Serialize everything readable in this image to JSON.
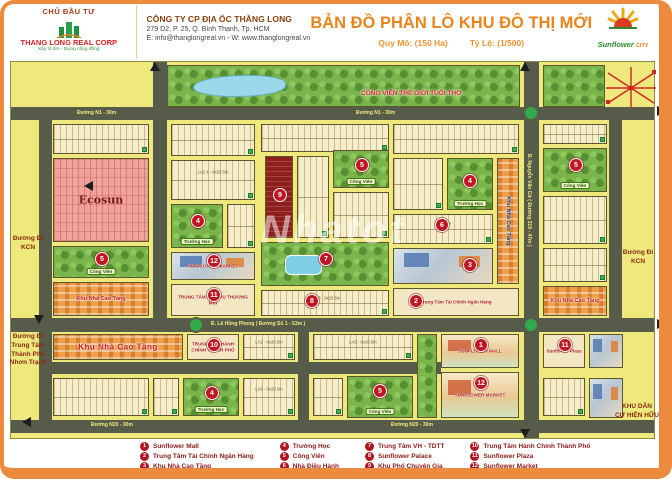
{
  "header": {
    "investor_label": "CHỦ ĐẦU TƯ",
    "logo_name": "THANG LONG REAL CORP",
    "logo_tagline": "Xây tổ ấm - Dựng cộng đồng",
    "company_name": "CÔNG TY CP ĐỊA ỐC THĂNG LONG",
    "company_address": "279 D2, P. 25, Q. Bình Thạnh, Tp. HCM",
    "company_contact": "E: info@thanglongreal.vn - W: www.thanglongreal.vn",
    "title": "BẢN ĐỒ PHÂN LÔ KHU ĐÔ THỊ MỚI",
    "scale_left": "Quy Mô: (150 Ha)",
    "scale_right": "Tỷ Lệ: (1/500)",
    "brand_name": "Sunflower",
    "brand_suffix": "CITY"
  },
  "colors": {
    "frame": "#ec8a3d",
    "title": "#e8851c",
    "road": "#575b4a",
    "map_bg": "#efe87c",
    "marker": "#c01622",
    "legend_text": "#8b1a1a",
    "park": "#79b54a",
    "highrise": "#eda04b",
    "ecosun_pink": "#f0a29b"
  },
  "map": {
    "watermark": "Nhatot",
    "items": [
      {
        "cls": "rh",
        "name": "road-n1",
        "x": 0,
        "y": 45,
        "w": 645,
        "h": 13
      },
      {
        "cls": "rh",
        "name": "road-le-hong-phong",
        "x": 0,
        "y": 256,
        "w": 645,
        "h": 14
      },
      {
        "cls": "rh",
        "name": "road-internal",
        "x": 28,
        "y": 300,
        "w": 402,
        "h": 12
      },
      {
        "cls": "rh",
        "name": "road-n20",
        "x": 0,
        "y": 358,
        "w": 645,
        "h": 13
      },
      {
        "cls": "rv",
        "name": "road-west-edge",
        "x": 28,
        "y": 45,
        "w": 13,
        "h": 326
      },
      {
        "cls": "rv",
        "name": "road-d1",
        "x": 142,
        "y": 0,
        "w": 14,
        "h": 270
      },
      {
        "cls": "rv",
        "name": "road-nguyen-van-cu",
        "x": 513,
        "y": 0,
        "w": 15,
        "h": 378
      },
      {
        "cls": "rv",
        "name": "road-east-edge",
        "x": 598,
        "y": 45,
        "w": 13,
        "h": 225
      },
      {
        "cls": "rv",
        "name": "road-internal-v",
        "x": 287,
        "y": 270,
        "w": 11,
        "h": 88
      },
      {
        "cls": "rb",
        "name": "roundabout",
        "x": 177,
        "y": 255
      },
      {
        "cls": "rb",
        "name": "roundabout",
        "x": 512,
        "y": 43
      },
      {
        "cls": "rb",
        "name": "roundabout",
        "x": 512,
        "y": 255
      },
      {
        "cls": "parkl",
        "name": "park-childhood-world",
        "x": 156,
        "y": 3,
        "w": 353,
        "h": 42
      },
      {
        "cls": "park",
        "name": "park-northeast",
        "x": 532,
        "y": 3,
        "w": 62,
        "h": 42
      },
      {
        "cls": "lots",
        "x": 42,
        "y": 62,
        "w": 96,
        "h": 30
      },
      {
        "cls": "pink",
        "name": "ecosun-area",
        "x": 42,
        "y": 96,
        "w": 96,
        "h": 84,
        "label": "Ecosun"
      },
      {
        "cls": "park",
        "name": "park-block",
        "x": 42,
        "y": 184,
        "w": 96,
        "h": 32,
        "chip": "Công Viên"
      },
      {
        "cls": "hi",
        "name": "highrise-block",
        "x": 42,
        "y": 220,
        "w": 96,
        "h": 34,
        "label": "Khu Nhà Cao Tầng"
      },
      {
        "cls": "lots",
        "x": 160,
        "y": 62,
        "w": 84,
        "h": 32
      },
      {
        "cls": "lots",
        "x": 160,
        "y": 98,
        "w": 84,
        "h": 40,
        "sub": "LA1.4 - 9x20.5m"
      },
      {
        "cls": "park",
        "name": "school-block",
        "x": 160,
        "y": 142,
        "w": 52,
        "h": 44,
        "chip": "Trường Học"
      },
      {
        "cls": "lots",
        "x": 216,
        "y": 142,
        "w": 28,
        "h": 44
      },
      {
        "cls": "pic",
        "name": "sunflower-market-block",
        "x": 160,
        "y": 190,
        "w": 84,
        "h": 28,
        "label": "SUNFLOWER MARKET"
      },
      {
        "cls": "pic2",
        "name": "trade-service-center-block",
        "x": 160,
        "y": 222,
        "w": 84,
        "h": 32,
        "label": "TRUNG TÂM DỊCH VỤ THƯƠNG MẠI"
      },
      {
        "cls": "lots",
        "x": 250,
        "y": 62,
        "w": 128,
        "h": 28
      },
      {
        "cls": "red",
        "name": "expert-quarter-block",
        "x": 254,
        "y": 94,
        "w": 28,
        "h": 82
      },
      {
        "cls": "lots",
        "x": 286,
        "y": 94,
        "w": 32,
        "h": 82
      },
      {
        "cls": "park",
        "name": "park-block",
        "x": 322,
        "y": 88,
        "w": 56,
        "h": 38,
        "chip": "Công Viên"
      },
      {
        "cls": "lots",
        "x": 322,
        "y": 130,
        "w": 56,
        "h": 46
      },
      {
        "cls": "parkp",
        "name": "sport-culture-center",
        "x": 250,
        "y": 180,
        "w": 128,
        "h": 44
      },
      {
        "cls": "lots",
        "x": 250,
        "y": 228,
        "w": 128,
        "h": 26,
        "sub": "LA2.8 - 9x20.5m"
      },
      {
        "cls": "lots",
        "x": 382,
        "y": 62,
        "w": 126,
        "h": 30
      },
      {
        "cls": "lots",
        "x": 382,
        "y": 96,
        "w": 50,
        "h": 52
      },
      {
        "cls": "park",
        "name": "school-block",
        "x": 436,
        "y": 96,
        "w": 46,
        "h": 52,
        "chip": "Trường Học"
      },
      {
        "cls": "lots",
        "x": 382,
        "y": 152,
        "w": 100,
        "h": 30,
        "sub": "9x20.5m"
      },
      {
        "cls": "pic",
        "name": "highrise-towers-block",
        "x": 382,
        "y": 186,
        "w": 100,
        "h": 36
      },
      {
        "cls": "pic2",
        "name": "finance-bank-center-block",
        "x": 382,
        "y": 226,
        "w": 126,
        "h": 28,
        "label": "Trung Tâm Tài Chính Ngân Hàng"
      },
      {
        "cls": "hiv",
        "name": "highrise-strip",
        "x": 486,
        "y": 96,
        "w": 22,
        "h": 126,
        "label": "Khu Nhà Cao Tầng"
      },
      {
        "cls": "lots",
        "x": 532,
        "y": 62,
        "w": 64,
        "h": 20
      },
      {
        "cls": "park",
        "name": "park-block",
        "x": 532,
        "y": 86,
        "w": 64,
        "h": 44,
        "chip": "Công Viên"
      },
      {
        "cls": "lots",
        "x": 532,
        "y": 134,
        "w": 64,
        "h": 48
      },
      {
        "cls": "lots",
        "x": 532,
        "y": 186,
        "w": 64,
        "h": 34
      },
      {
        "cls": "hi",
        "name": "highrise-block",
        "x": 532,
        "y": 224,
        "w": 64,
        "h": 30,
        "label": "Khu Nhà Cao Tầng"
      },
      {
        "cls": "hi",
        "name": "highrise-block",
        "big": true,
        "x": 42,
        "y": 272,
        "w": 130,
        "h": 26,
        "label": "Khu Nhà Cao Tầng"
      },
      {
        "cls": "pic2",
        "name": "city-admin-center-block",
        "x": 176,
        "y": 272,
        "w": 52,
        "h": 26,
        "label": "TRUNG TÂM HÀNH CHÍNH THÀNH PHỐ"
      },
      {
        "cls": "lots",
        "x": 232,
        "y": 272,
        "w": 52,
        "h": 26,
        "sub": "LA2 - 9x20.5m"
      },
      {
        "cls": "lots",
        "x": 302,
        "y": 272,
        "w": 100,
        "h": 26,
        "sub": "LA5 - 9x20.5m"
      },
      {
        "cls": "park",
        "name": "park-strip",
        "x": 406,
        "y": 272,
        "w": 20,
        "h": 84
      },
      {
        "cls": "mall",
        "name": "sunflower-mall-block",
        "x": 430,
        "y": 272,
        "w": 78,
        "h": 34,
        "label": "SUNFLOWER MALL"
      },
      {
        "cls": "mall",
        "name": "sunflower-market-block",
        "x": 430,
        "y": 310,
        "w": 78,
        "h": 46,
        "label": "SUNFLOWER MARKET"
      },
      {
        "cls": "pic2",
        "name": "sunflower-plaza-block",
        "x": 532,
        "y": 272,
        "w": 42,
        "h": 34,
        "label": "Sunflower Plaza"
      },
      {
        "cls": "pic",
        "name": "tower-block",
        "x": 578,
        "y": 272,
        "w": 34,
        "h": 34
      },
      {
        "cls": "lots",
        "x": 42,
        "y": 316,
        "w": 96,
        "h": 38
      },
      {
        "cls": "lots",
        "x": 142,
        "y": 316,
        "w": 26,
        "h": 38
      },
      {
        "cls": "park",
        "name": "school-block",
        "x": 172,
        "y": 316,
        "w": 56,
        "h": 38,
        "chip": "Trường Học"
      },
      {
        "cls": "lots",
        "x": 232,
        "y": 316,
        "w": 52,
        "h": 38,
        "sub": "LA6 - 9x20.5m"
      },
      {
        "cls": "lots",
        "x": 302,
        "y": 316,
        "w": 30,
        "h": 38
      },
      {
        "cls": "park",
        "name": "park-block",
        "x": 336,
        "y": 314,
        "w": 66,
        "h": 42,
        "chip": "Công Viên"
      },
      {
        "cls": "lots",
        "x": 532,
        "y": 316,
        "w": 42,
        "h": 38
      },
      {
        "cls": "pic",
        "name": "tower-block",
        "x": 578,
        "y": 316,
        "w": 34,
        "h": 40
      }
    ],
    "markers": [
      {
        "x": 463,
        "y": 276,
        "n": "1"
      },
      {
        "x": 398,
        "y": 232,
        "n": "2"
      },
      {
        "x": 452,
        "y": 196,
        "n": "3"
      },
      {
        "x": 180,
        "y": 152,
        "n": "4"
      },
      {
        "x": 452,
        "y": 112,
        "n": "4"
      },
      {
        "x": 194,
        "y": 324,
        "n": "4"
      },
      {
        "x": 84,
        "y": 190,
        "n": "5"
      },
      {
        "x": 344,
        "y": 96,
        "n": "5"
      },
      {
        "x": 558,
        "y": 96,
        "n": "5"
      },
      {
        "x": 362,
        "y": 322,
        "n": "5"
      },
      {
        "x": 424,
        "y": 156,
        "n": "6"
      },
      {
        "x": 308,
        "y": 190,
        "n": "7"
      },
      {
        "x": 294,
        "y": 232,
        "n": "8"
      },
      {
        "x": 262,
        "y": 126,
        "n": "9"
      },
      {
        "x": 196,
        "y": 276,
        "n": "10"
      },
      {
        "x": 196,
        "y": 226,
        "n": "11"
      },
      {
        "x": 547,
        "y": 276,
        "n": "11"
      },
      {
        "x": 196,
        "y": 192,
        "n": "12"
      },
      {
        "x": 463,
        "y": 314,
        "n": "12"
      }
    ],
    "map_texts": [
      {
        "cls": "lblred",
        "x": 350,
        "y": 28,
        "t": "CÔNG VIÊN THẾ GIỚI TUỔI THƠ"
      },
      {
        "cls": "wm",
        "x": 250,
        "y": 146,
        "t": "Nhatot"
      }
    ],
    "road_labels": [
      {
        "x": 66,
        "y": 48,
        "t": "Đường N1 - 30m"
      },
      {
        "x": 345,
        "y": 48,
        "t": "Đường N1 - 30m"
      },
      {
        "x": 200,
        "y": 259,
        "t": "Đ. Lê Hồng Phong ( Đường Số 1 - 53m )"
      },
      {
        "x": 80,
        "y": 360,
        "t": "Đường N20 - 30m"
      },
      {
        "x": 380,
        "y": 360,
        "t": "Đường N20 - 30m"
      },
      {
        "x": 515,
        "y": 92,
        "t": "Đ. Nguyễn Văn Cừ ( Đường 319 - 47m )",
        "vert": 1
      }
    ],
    "edge_labels": [
      {
        "x": 6,
        "y": 174,
        "w": 44,
        "lines": [
          "Đường Đi",
          "KCN"
        ]
      },
      {
        "x": 2,
        "y": 272,
        "w": 52,
        "lines": [
          "Đường Đi",
          "Trung Tâm",
          "Thành Phố",
          "Nhơn Trạch"
        ]
      },
      {
        "x": 614,
        "y": 188,
        "w": 48,
        "lines": [
          "Đường Đi",
          "KCN"
        ]
      },
      {
        "x": 610,
        "y": 342,
        "w": 54,
        "lines": [
          "KHU DÂN",
          "CƯ HIỆN HỮU"
        ]
      }
    ],
    "arrows": [
      {
        "dir": "up",
        "x": 150,
        "y": 1
      },
      {
        "dir": "up",
        "x": 520,
        "y": 1
      },
      {
        "dir": "down",
        "x": 520,
        "y": 368
      },
      {
        "dir": "right",
        "x": 657,
        "y": 45
      },
      {
        "dir": "right",
        "x": 657,
        "y": 258
      },
      {
        "dir": "left",
        "x": 84,
        "y": 120
      },
      {
        "dir": "down",
        "x": 34,
        "y": 254
      },
      {
        "dir": "left",
        "x": 22,
        "y": 356
      }
    ]
  },
  "legend": {
    "columns": [
      [
        {
          "n": "1",
          "t": "Sunflower Mall"
        },
        {
          "n": "2",
          "t": "Trung Tâm Tài Chính Ngân Hàng"
        },
        {
          "n": "3",
          "t": "Khu Nhà Cao Tầng"
        }
      ],
      [
        {
          "n": "4",
          "t": "Trường Học"
        },
        {
          "n": "5",
          "t": "Công Viên"
        },
        {
          "n": "6",
          "t": "Nhà Điều Hành"
        }
      ],
      [
        {
          "n": "7",
          "t": "Trung Tâm VH - TDTT"
        },
        {
          "n": "8",
          "t": "Sunflower Palace"
        },
        {
          "n": "9",
          "t": "Khu Phố Chuyên Gia"
        }
      ],
      [
        {
          "n": "10",
          "t": "Trung Tâm Hành Chính Thành Phố"
        },
        {
          "n": "11",
          "t": "Sunflower Plaza"
        },
        {
          "n": "12",
          "t": "Sunflower Market"
        }
      ]
    ]
  }
}
